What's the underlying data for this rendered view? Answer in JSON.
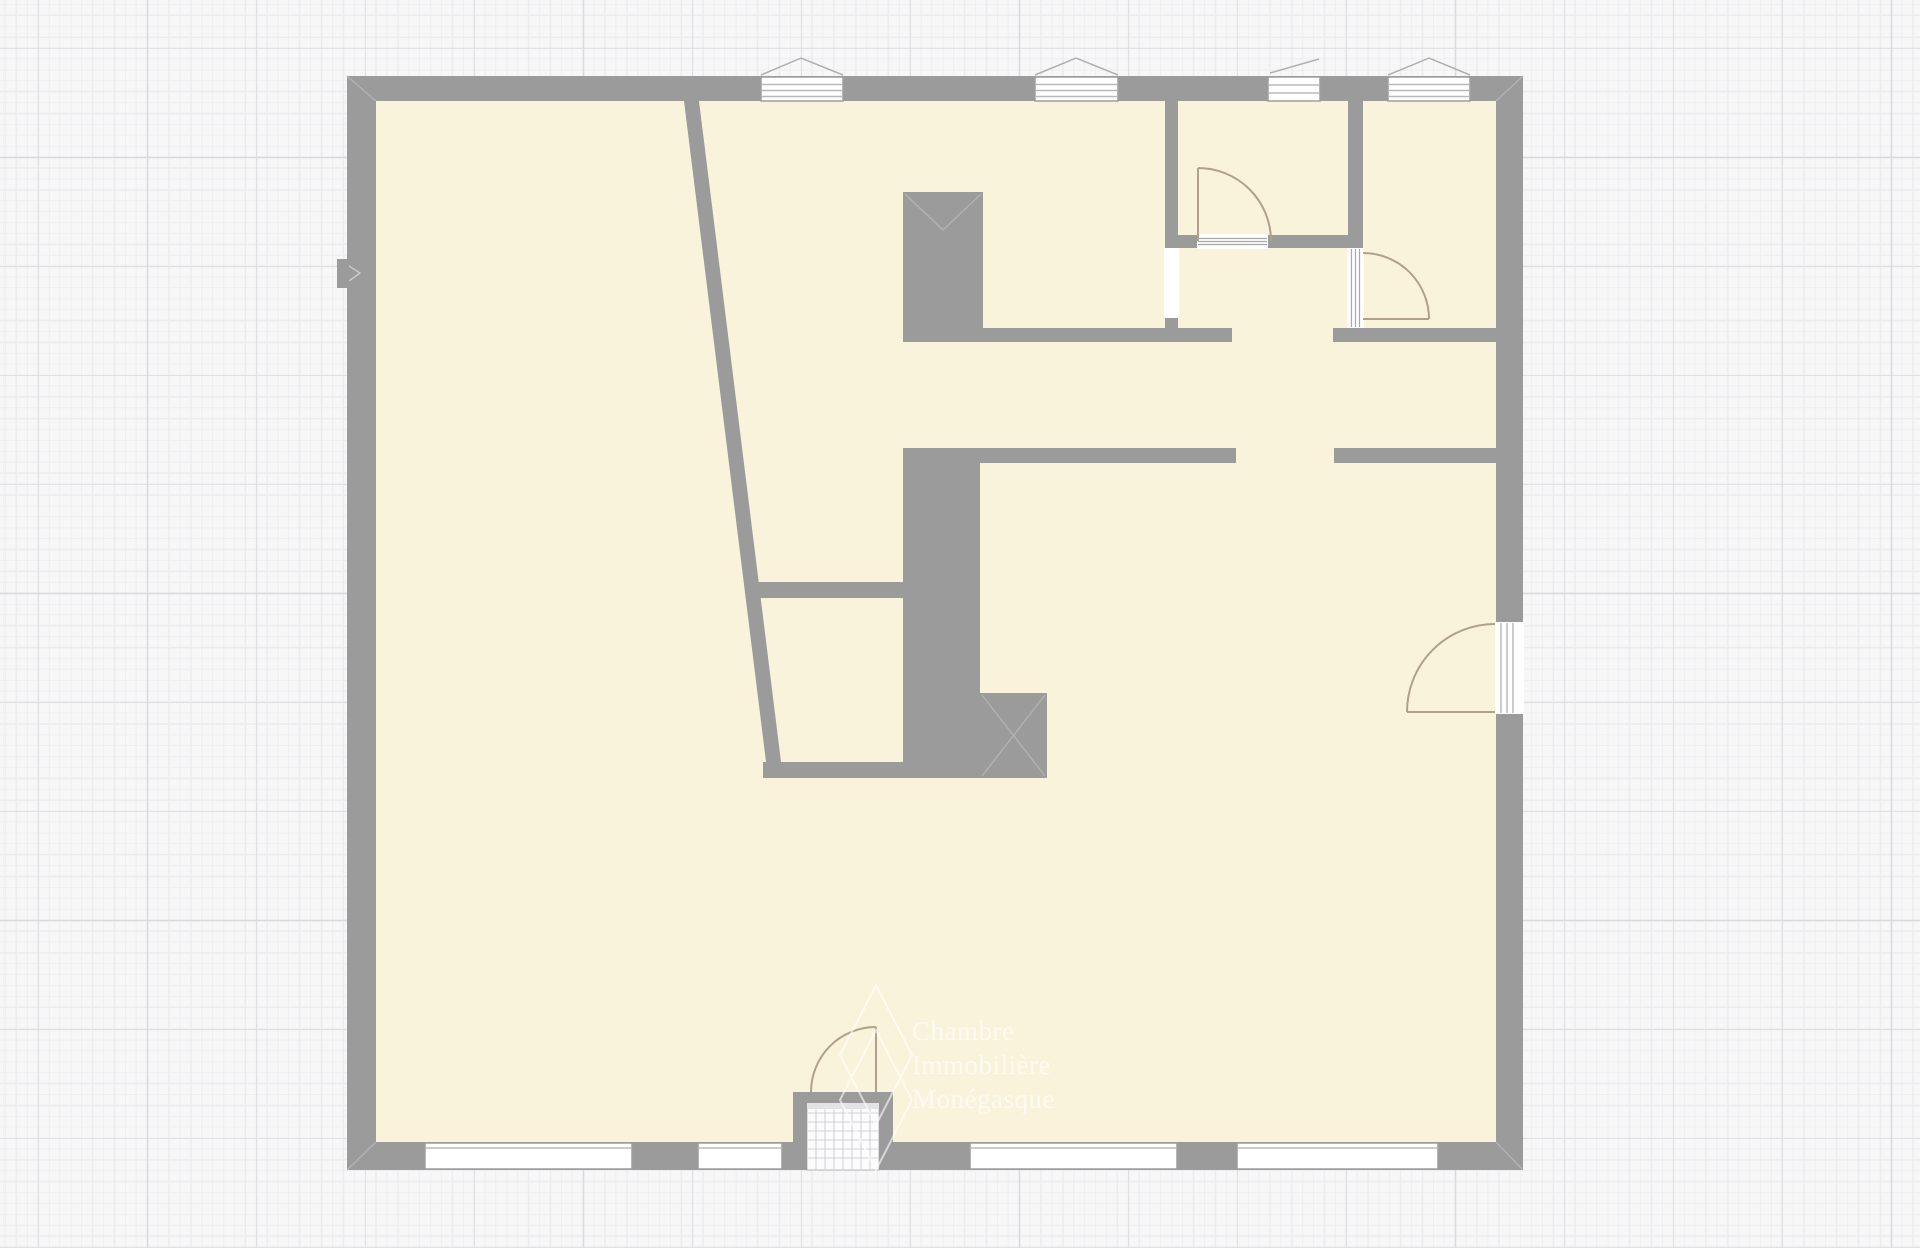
{
  "canvas": {
    "background_color": "#f7f7f8",
    "grid_minor_color": "#ececef",
    "grid_major_color": "#d9d9de",
    "grid_minor_spacing_px": 10.9,
    "grid_major_spacing_px": 109
  },
  "plan": {
    "wall_color": "#9b9b9b",
    "floor_color": "#faf3dc",
    "door_arc_color": "#b0a18d",
    "window_fill_color": "#ffffff",
    "counts": {
      "top_windows": 4,
      "bottom_windows": 4,
      "interior_doors": 2,
      "wall_openings": 1,
      "exterior_doors": 2
    }
  },
  "watermark": {
    "lines": [
      "Chambre",
      "Immobilière",
      "Monégasque"
    ],
    "text_color": "#ffffff",
    "logo": "double-diamond-outline"
  }
}
